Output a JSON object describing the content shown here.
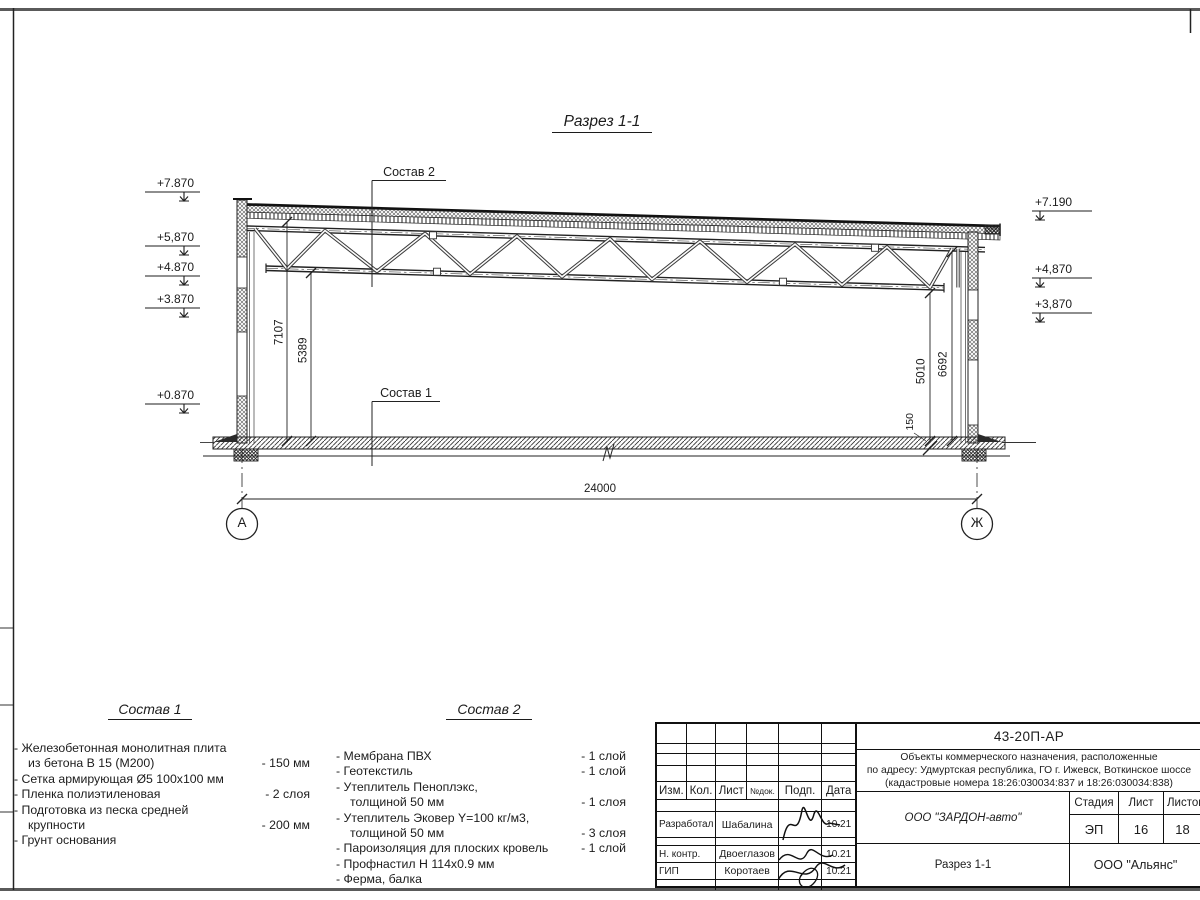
{
  "section": {
    "title": "Разрез 1-1",
    "callout_roof": "Состав 2",
    "callout_floor": "Состав 1",
    "elev_left": [
      "+7.870",
      "+5,870",
      "+4.870",
      "+3.870",
      "+0.870"
    ],
    "elev_right": [
      "+7.190",
      "+4,870",
      "+3,870"
    ],
    "dim_span": "24000",
    "dim_left_outer": "7107",
    "dim_left_inner": "5389",
    "dim_right_outer": "6692",
    "dim_right_inner": "5010",
    "dim_slab": "150",
    "axis_left": "А",
    "axis_right": "Ж"
  },
  "composition1": {
    "title": "Состав 1",
    "lines": [
      {
        "t": "- Железобетонная  монолитная плита",
        "v": ""
      },
      {
        "t": "из бетона В 15 (М200)",
        "v": "- 150 мм"
      },
      {
        "t": "- Сетка армирующая Ø5 100x100 мм",
        "v": ""
      },
      {
        "t": "- Пленка полиэтиленовая",
        "v": "- 2 слоя"
      },
      {
        "t": "- Подготовка из песка средней",
        "v": ""
      },
      {
        "t": "крупности",
        "v": "- 200 мм"
      },
      {
        "t": "- Грунт основания",
        "v": ""
      }
    ]
  },
  "composition2": {
    "title": "Состав 2",
    "lines": [
      {
        "t": "- Мембрана ПВХ",
        "v": "- 1 слой"
      },
      {
        "t": "- Геотекстиль",
        "v": "- 1 слой"
      },
      {
        "t": "- Утеплитель Пеноплэкс,",
        "v": ""
      },
      {
        "t": "толщиной 50 мм",
        "v": "- 1 слоя"
      },
      {
        "t": "- Утеплитель Эковер Y=100 кг/м3,",
        "v": ""
      },
      {
        "t": "толщиной 50 мм",
        "v": "- 3 слоя"
      },
      {
        "t": "- Пароизоляция для плоских кровель",
        "v": "- 1 слой"
      },
      {
        "t": "- Профнастил Н 114x0.9 мм",
        "v": ""
      },
      {
        "t": "- Ферма, балка",
        "v": ""
      }
    ]
  },
  "titleblock": {
    "code": "43-20П-АР",
    "project": [
      "Объекты коммерческого назначения, расположенные",
      "по адресу: Удмуртская республика, ГО г. Ижевск, Воткинское шоссе",
      "(кадастровые номера 18:26:030034:837 и 18:26:030034:838)"
    ],
    "cols": [
      "Изм.",
      "Кол.",
      "Лист",
      "№док.",
      "Подп.",
      "Дата"
    ],
    "sig_rows": [
      {
        "role": "Разработал",
        "name": "Шабалина",
        "date": "10.21"
      },
      {
        "role": "Н. контр.",
        "name": "Двоеглазов",
        "date": "10.21"
      },
      {
        "role": "ГИП",
        "name": "Коротаев",
        "date": "10.21"
      }
    ],
    "org": "ООО \"ЗАРДОН-авто\"",
    "stage_label": "Стадия",
    "sheet_label": "Лист",
    "sheets_label": "Листов",
    "stage": "ЭП",
    "sheet": "16",
    "sheets": "18",
    "sheet_name": "Разрез 1-1",
    "company": "ООО \"Альянс\""
  }
}
